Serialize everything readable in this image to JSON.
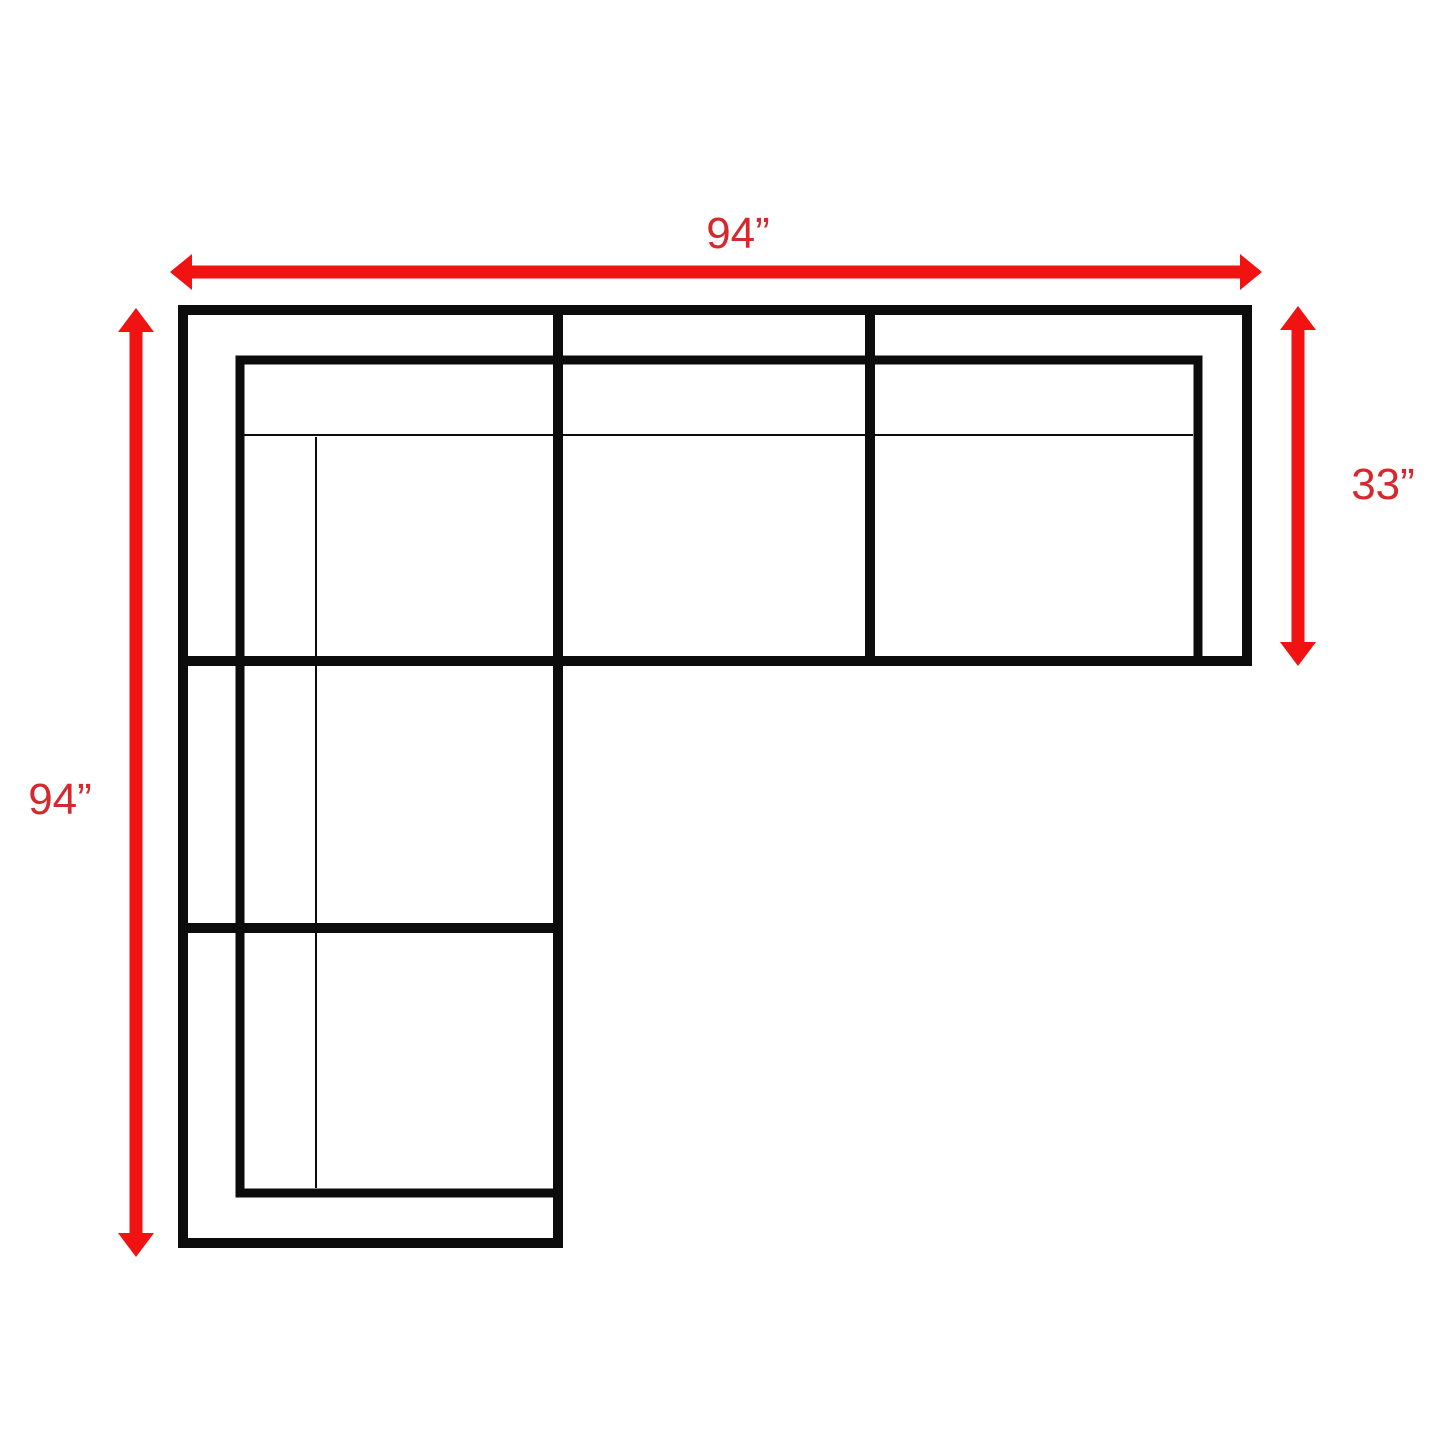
{
  "diagram": {
    "title": "sectional-sofa-dimension-diagram-top-view",
    "labels": {
      "top_width": "94”",
      "left_height": "94”",
      "right_depth": "33”"
    },
    "dimensions": [
      {
        "side": "top",
        "value_inches": 94,
        "text": "94”"
      },
      {
        "side": "left",
        "value_inches": 94,
        "text": "94”"
      },
      {
        "side": "right",
        "value_inches": 33,
        "text": "33”"
      }
    ],
    "colors": {
      "dimension": "#f11212",
      "label": "#d6282d",
      "outline": "#0c0c0c",
      "background": "#ffffff"
    }
  }
}
